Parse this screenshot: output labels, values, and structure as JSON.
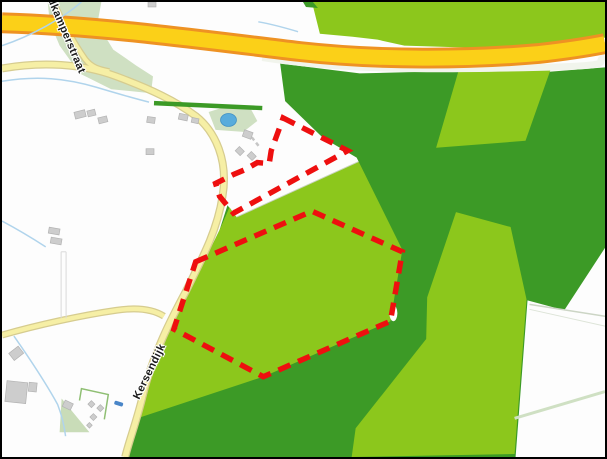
{
  "map": {
    "road_labels": [
      {
        "id": "kamperstraat",
        "text": "dkamperstraat"
      },
      {
        "id": "kersendijk",
        "text": "Kersendijk"
      }
    ],
    "parcel_outlines": {
      "color": "#ee0f0f",
      "style": "dashed",
      "upper_points": "283,117 348,150 233,213 219,196 215,183 233,174 245,169 257,162 269,163 271,150",
      "lower_points": "195,262 312,211 403,252 391,322 263,378 173,330"
    },
    "palette": {
      "field_light_green": "#8cc71c",
      "forest_dark_green": "#3c9a26",
      "motorway_yellow": "#fbd018",
      "motorway_casing_orange": "#ee9223",
      "minor_road_fill": "#f6efa5",
      "minor_road_casing": "#d6cc8f",
      "water_blue": "#b0d4ec",
      "pond_blue": "#58acdc",
      "building_gray": "#cdcdcd",
      "interchange_pale_green": "#cfe0c2"
    }
  }
}
